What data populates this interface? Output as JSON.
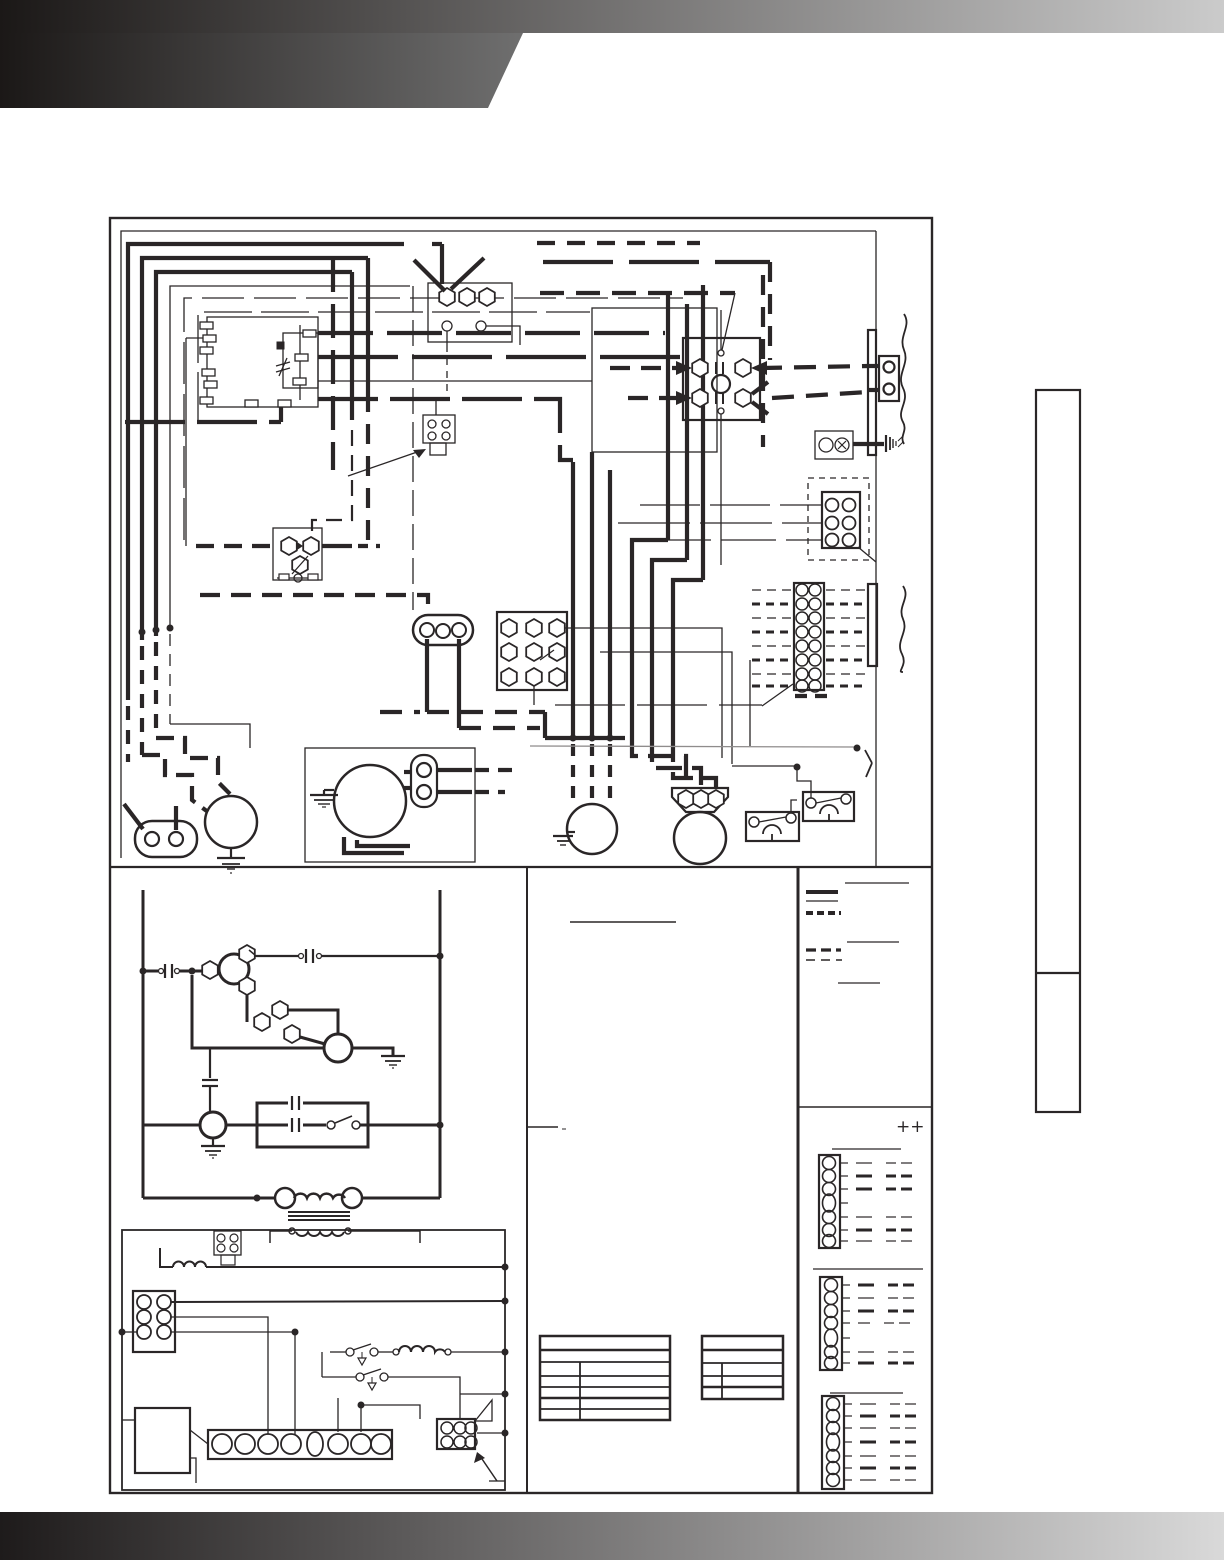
{
  "page": {
    "kind": "scanned wiring diagram page (text layer not rendered)",
    "background_color": "#ffffff",
    "line_color": "#2a2627"
  },
  "header": {
    "top_strip_gradient": [
      "#1b1817",
      "#cbcbcb"
    ],
    "band_gradient": [
      "#1b1817",
      "#757575"
    ],
    "band_shape": "left block with angled right edge"
  },
  "footer": {
    "gradient": [
      "#1e1b1b",
      "#d9d9d9"
    ]
  },
  "legend": {
    "note_marker": "++",
    "line_samples": [
      "thick-solid-line-sample",
      "thin-solid-line-sample",
      "thick-dashed-line-sample",
      "medium-dashed-line-sample",
      "thin-dashed-line-sample"
    ],
    "thermostat_hookup_strips": 3
  },
  "diagram": {
    "panels": [
      "upper-wiring-panel",
      "lower-left-ladder-schematic",
      "lower-middle-notes-column",
      "lower-right-legend-column"
    ],
    "components": [
      "control-board",
      "door-interlock-switch",
      "plug-connector-4pin",
      "relay",
      "oval-connector-3pin",
      "terminal-block-9-lug",
      "contactor",
      "field-wiring-bracket",
      "ground-lug",
      "plug-2pin",
      "plug-6pin",
      "low-voltage-terminal-strip-16",
      "induced-draft-motor",
      "blower-motor-box",
      "blower-motor",
      "compressor",
      "pressure-switch-1",
      "pressure-switch-2",
      "capacitor",
      "transformer",
      "gas-control-section",
      "igniter-box",
      "burner-terminal-strip-8",
      "flame-rollout-switches",
      "tables"
    ]
  },
  "sidebar_tab": {
    "divided": true,
    "border_color": "#2a2627"
  }
}
